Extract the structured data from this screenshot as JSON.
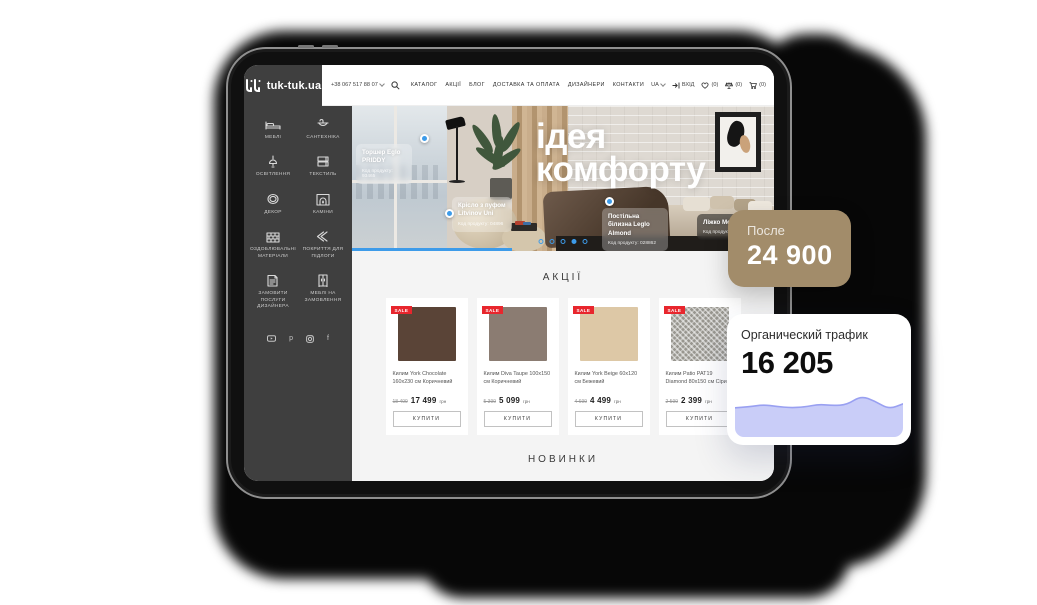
{
  "site": {
    "logo_text": "tuk-tuk.ua",
    "theme": {
      "accent_blue": "#3d9be9",
      "sale_red": "#e8262d",
      "sidebar_bg": "#3f3f3f",
      "card_brown": "#a28c6a",
      "chart_fill": "#c9cdf8",
      "chart_line": "#99a0f1"
    },
    "header": {
      "phone": "+38 067 517 88 07",
      "nav": [
        "КАТАЛОГ",
        "АКЦІЇ",
        "БЛОГ",
        "ДОСТАВКА ТА ОПЛАТА",
        "ДИЗАЙНЕРИ",
        "КОНТАКТИ"
      ],
      "lang": "UA",
      "login_label": "ВХІД",
      "wishlist_count": "(0)",
      "compare_count": "(0)",
      "cart_count": "(0)"
    },
    "sidebar": {
      "items": [
        {
          "label": "МЕБЛІ",
          "icon": "bed-icon"
        },
        {
          "label": "САНТЕХНІКА",
          "icon": "sink-icon"
        },
        {
          "label": "ОСВІТЛЕННЯ",
          "icon": "pendant-lamp-icon"
        },
        {
          "label": "ТЕКСТИЛЬ",
          "icon": "textile-icon"
        },
        {
          "label": "ДЕКОР",
          "icon": "mirror-icon"
        },
        {
          "label": "КАМІНИ",
          "icon": "fireplace-icon"
        },
        {
          "label": "ОЗДОБЛЮВАЛЬНІ МАТЕРІАЛИ",
          "icon": "bricks-icon"
        },
        {
          "label": "ПОКРИТТЯ ДЛЯ ПІДЛОГИ",
          "icon": "flooring-icon"
        },
        {
          "label": "ЗАМОВИТИ ПОСЛУГИ ДИЗАЙНЕРА",
          "icon": "designer-icon"
        },
        {
          "label": "МЕБЛІ НА ЗАМОВЛЕННЯ",
          "icon": "wardrobe-icon"
        }
      ],
      "socials": [
        "youtube",
        "pinterest",
        "instagram",
        "facebook"
      ]
    },
    "hero": {
      "title_line1": "ідея",
      "title_line2": "комфорту",
      "hotspots": [
        {
          "name": "Торшер Eglo PRIDDY",
          "code": "Код продукту: 93465"
        },
        {
          "name": "Крісло з пуфом Litvinov Uni",
          "code": "Код продукту: 04896"
        },
        {
          "name": "Постільна білизна Leglo Almond",
          "code": "Код продукту: 028862"
        },
        {
          "name": "Ліжко Mon Bo",
          "code": "Код продукту:"
        }
      ],
      "carousel": {
        "dots": 5,
        "active_index": 3
      }
    },
    "sections": {
      "sale_title": "АКЦІЇ",
      "new_title": "НОВИНКИ",
      "buy_label": "КУПИТИ"
    },
    "products": [
      {
        "badge": "SALE",
        "name": "Килим York Chocolate 160x230 см Коричневий",
        "old_price": "18 499",
        "price": "17 499",
        "currency": "грн",
        "swatch": "#5a4437"
      },
      {
        "badge": "SALE",
        "name": "Килим Diva Taupe 100x150 см Коричневий",
        "old_price": "5 399",
        "price": "5 099",
        "currency": "грн",
        "swatch": "#8b7c72"
      },
      {
        "badge": "SALE",
        "name": "Килим York Beige 60x120 см Бежевий",
        "old_price": "4 699",
        "price": "4 499",
        "currency": "грн",
        "swatch": "#ddc8a6"
      },
      {
        "badge": "SALE",
        "name": "Килим Patio PAT19 Diamond 80x150 см Сірий",
        "old_price": "2 599",
        "price": "2 399",
        "currency": "грн",
        "swatch": "#98968f"
      }
    ]
  },
  "overlays": {
    "after_card": {
      "label": "После",
      "value": "24 900",
      "bg": "#a28c6a"
    },
    "traffic_card": {
      "title": "Органический трафик",
      "value": "16 205"
    }
  },
  "chart_data": {
    "type": "area",
    "title": "Органический трафик",
    "value_label": "16 205",
    "x": [
      0,
      1,
      2,
      3,
      4,
      5,
      6,
      7,
      8,
      9,
      10,
      11,
      12
    ],
    "values": [
      55,
      57,
      62,
      58,
      55,
      57,
      63,
      60,
      62,
      82,
      70,
      52,
      64
    ],
    "xlabel": "",
    "ylabel": "",
    "ylim": [
      0,
      100
    ],
    "grid": false,
    "axes_hidden": true,
    "legend": "none",
    "fill": "#c9cdf8",
    "line": "#99a0f1"
  }
}
